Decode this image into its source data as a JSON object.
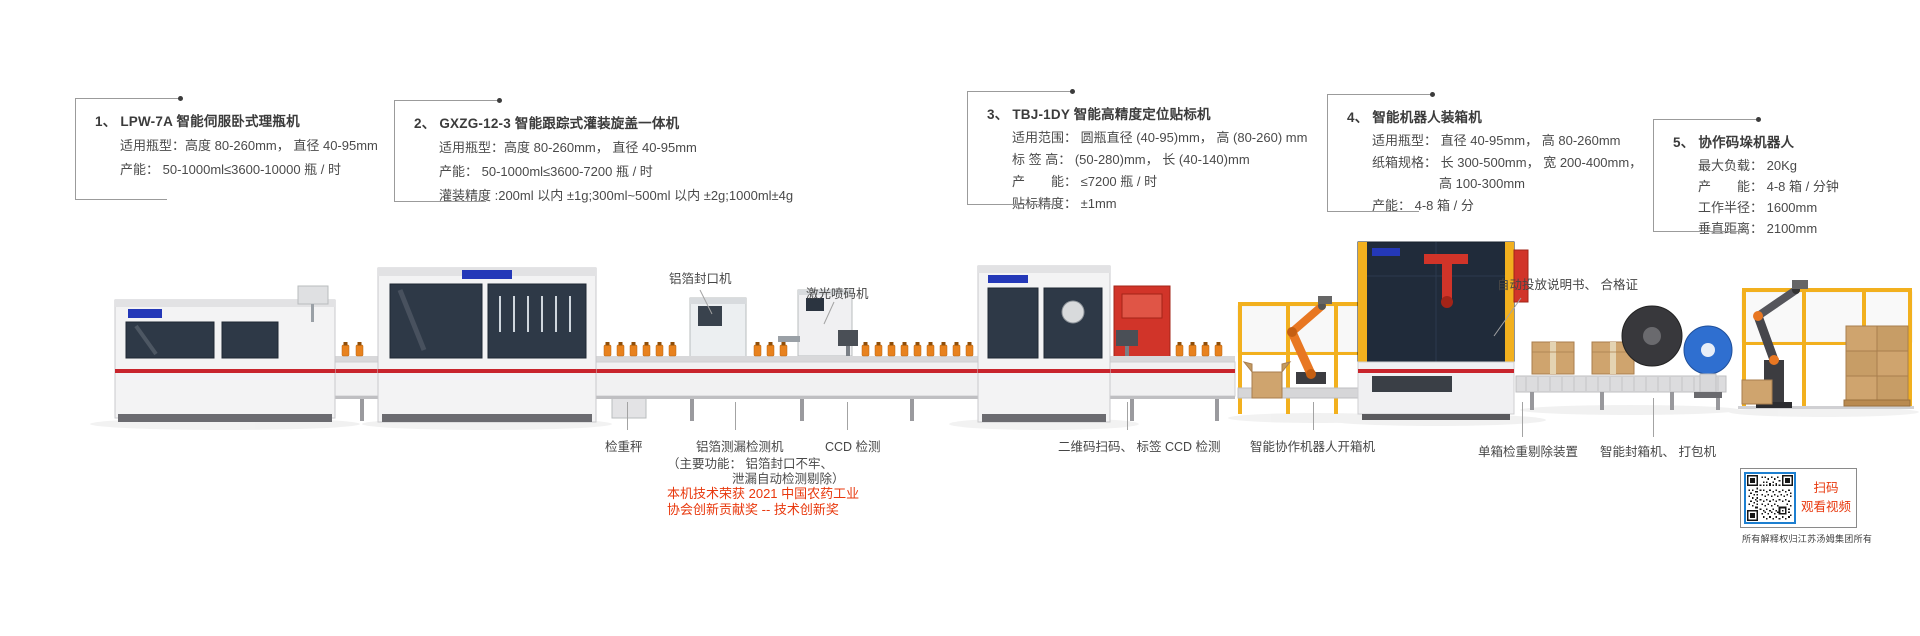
{
  "spec_blocks": [
    {
      "num_title": "1、 LPW-7A 智能伺服卧式理瓶机",
      "lines": [
        "适用瓶型：高度 80-260mm， 直径 40-95mm",
        "产能： 50-1000ml≤3600-10000 瓶 / 时"
      ]
    },
    {
      "num_title": "2、 GXZG-12-3 智能跟踪式灌装旋盖一体机",
      "lines": [
        "适用瓶型：高度 80-260mm， 直径 40-95mm",
        "产能： 50-1000ml≤3600-7200 瓶 / 时",
        "灌装精度 :200ml 以内 ±1g;300ml~500ml 以内 ±2g;1000ml±4g"
      ]
    },
    {
      "num_title": "3、 TBJ-1DY 智能高精度定位贴标机",
      "lines": [
        "适用范围： 圆瓶直径 (40-95)mm， 高 (80-260) mm",
        "标 签 高： (50-280)mm， 长 (40-140)mm",
        "产　　能： ≤7200 瓶 / 时",
        "贴标精度： ±1mm"
      ]
    },
    {
      "num_title": "4、 智能机器人装箱机",
      "lines": [
        "适用瓶型： 直径 40-95mm， 高 80-260mm",
        "纸箱规格： 长 300-500mm， 宽 200-400mm，",
        "高 100-300mm",
        "产能： 4-8 箱 / 分"
      ]
    },
    {
      "num_title": "5、 协作码垛机器人",
      "lines": [
        "最大负载： 20Kg",
        "产　　能： 4-8 箱 / 分钟",
        "工作半径： 1600mm",
        "垂直距离： 2100mm"
      ]
    }
  ],
  "inline_labels": {
    "foil_sealer": "铝箔封口机",
    "laser_coder": "激光喷码机",
    "manual_insert": "自动投放说明书、 合格证"
  },
  "bottom_labels": {
    "checkweigher": "检重秤",
    "foil_leak_detector": "铝箔测漏检测机",
    "foil_leak_note_1": "（主要功能： 铝箔封口不牢、",
    "foil_leak_note_2": "泄漏自动检测剔除）",
    "award_line_1": "本机技术荣获 2021 中国农药工业",
    "award_line_2": "协会创新贡献奖 -- 技术创新奖",
    "ccd_inspection": "CCD 检测",
    "qr_label_inspection": "二维码扫码、 标签 CCD 检测",
    "robot_carton_opener": "智能协作机器人开箱机",
    "single_box_reject": "单箱检重剔除装置",
    "sealer_strapper": "智能封箱机、 打包机"
  },
  "qr_panel": {
    "line1": "扫码",
    "line2": "观看视频"
  },
  "footer": {
    "copyright": "所有解释权归江苏汤姆集团所有"
  },
  "colors": {
    "accent_red_text": "#e8380d",
    "conveyor_stripe": "#c8242c",
    "safety_yellow": "#f2b01e",
    "robot_orange": "#e87722",
    "machine_window": "#2e3947",
    "logo_blue": "#2438b8",
    "qr_border_blue": "#1d7fd0",
    "carton_tan": "#cfa46e",
    "wheel_blue": "#2f6fd0",
    "line_gray": "#9b9b9b",
    "text_dark": "#404040"
  }
}
